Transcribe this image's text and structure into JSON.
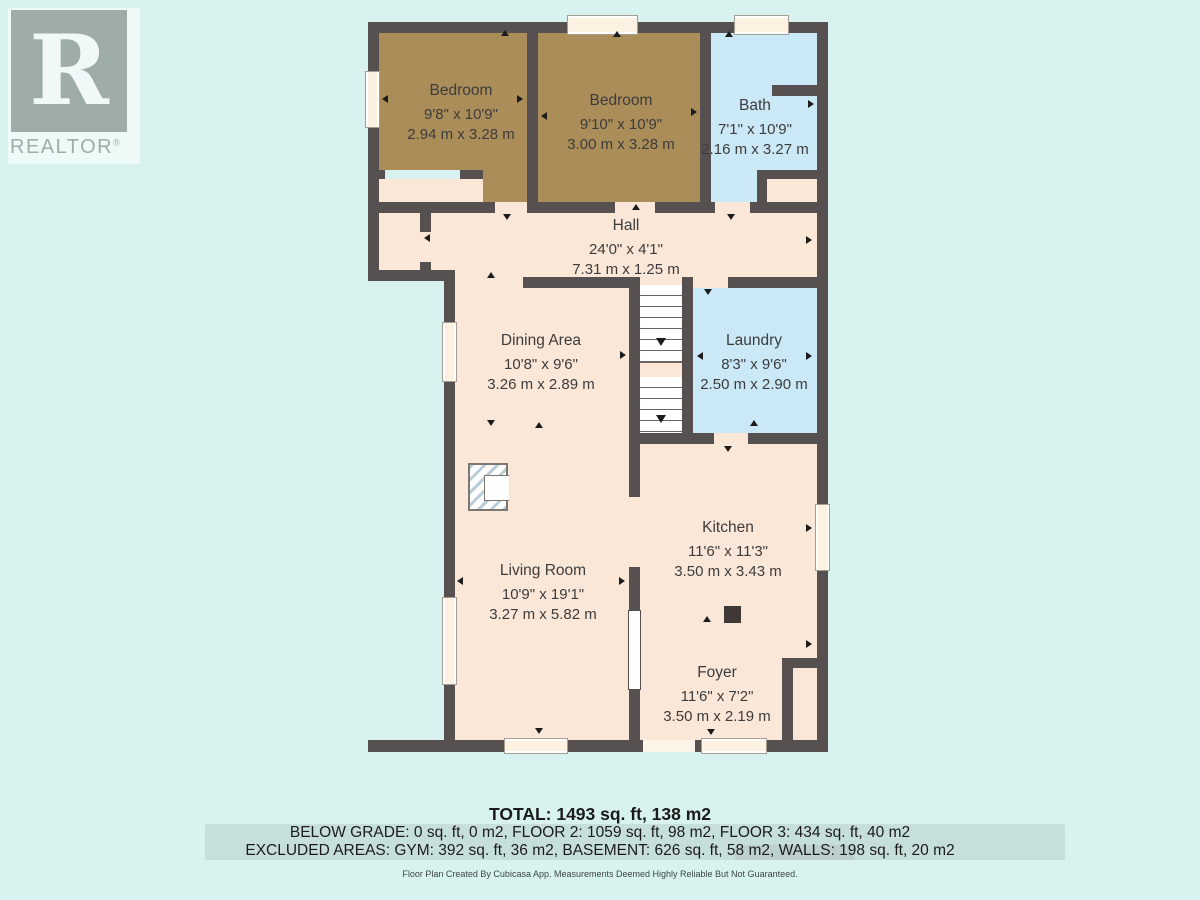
{
  "background_color": "#d8f3ef",
  "branding": {
    "logo_letter": "R",
    "logo_text": "REALTOR",
    "registered": "®"
  },
  "floor_plan": {
    "colors": {
      "wall": "#575050",
      "bedroom_fill": "#aa8d58",
      "wet_room_fill": "#cbe8f7",
      "room_fill": "#fbe7d8",
      "window_fill": "#fdf2e2",
      "stairs_fill": "#ffffff"
    },
    "rooms": [
      {
        "id": "bedroom-1",
        "name": "Bedroom",
        "imperial": "9'8\" x 10'9\"",
        "metric": "2.94 m x 3.28 m"
      },
      {
        "id": "bedroom-2",
        "name": "Bedroom",
        "imperial": "9'10\" x 10'9\"",
        "metric": "3.00 m x 3.28 m"
      },
      {
        "id": "bath",
        "name": "Bath",
        "imperial": "7'1\" x 10'9\"",
        "metric": "2.16 m x 3.27 m"
      },
      {
        "id": "hall",
        "name": "Hall",
        "imperial": "24'0\" x 4'1\"",
        "metric": "7.31 m x 1.25 m"
      },
      {
        "id": "dining-area",
        "name": "Dining Area",
        "imperial": "10'8\" x 9'6\"",
        "metric": "3.26 m x 2.89 m"
      },
      {
        "id": "laundry",
        "name": "Laundry",
        "imperial": "8'3\" x 9'6\"",
        "metric": "2.50 m x 2.90 m"
      },
      {
        "id": "kitchen",
        "name": "Kitchen",
        "imperial": "11'6\" x 11'3\"",
        "metric": "3.50 m x 3.43 m"
      },
      {
        "id": "living-room",
        "name": "Living Room",
        "imperial": "10'9\" x 19'1\"",
        "metric": "3.27 m x 5.82 m"
      },
      {
        "id": "foyer",
        "name": "Foyer",
        "imperial": "11'6\" x 7'2\"",
        "metric": "3.50 m x 2.19 m"
      }
    ]
  },
  "summary": {
    "total": "TOTAL: 1493 sq. ft, 138 m2",
    "breakdown": "BELOW GRADE: 0 sq. ft, 0 m2, FLOOR 2: 1059 sq. ft, 98 m2, FLOOR 3: 434 sq. ft, 40 m2",
    "excluded": "EXCLUDED AREAS: GYM: 392 sq. ft, 36 m2, BASEMENT: 626 sq. ft, 58 m2, WALLS: 198 sq. ft, 20 m2",
    "disclaimer": "Floor Plan Created By Cubicasa App. Measurements Deemed Highly Reliable But Not Guaranteed."
  }
}
